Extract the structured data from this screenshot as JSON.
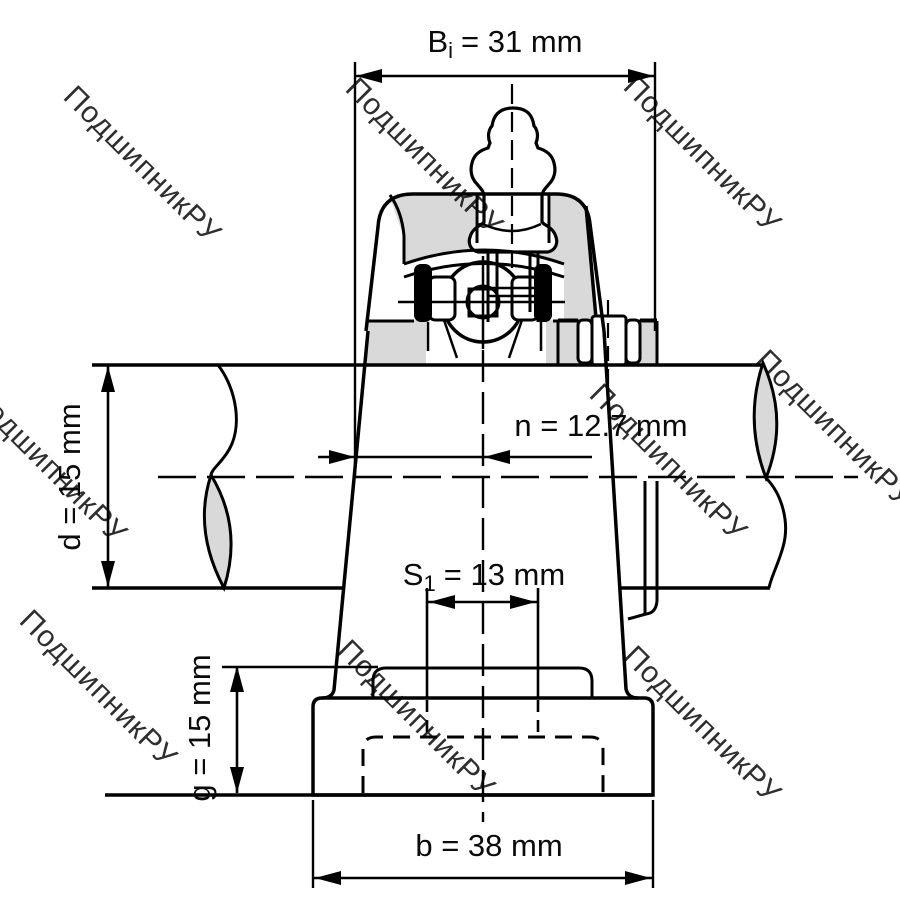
{
  "watermark": {
    "text": "ПодшипникРУ",
    "color": "#c3c3c3"
  },
  "dimensions": {
    "bi": {
      "symbol": "B",
      "subscript": "i",
      "rest": "= 31 mm"
    },
    "n": {
      "label": "n = 12.7 mm"
    },
    "d": {
      "label": "d = 15 mm"
    },
    "s1": {
      "symbol": "S",
      "subscript": "1",
      "rest": "= 13 mm"
    },
    "g": {
      "label": "g = 15 mm"
    },
    "b": {
      "label": "b = 38 mm"
    }
  },
  "colors": {
    "line": "#000000",
    "section_fill": "#d9d9d9",
    "background": "#ffffff"
  }
}
